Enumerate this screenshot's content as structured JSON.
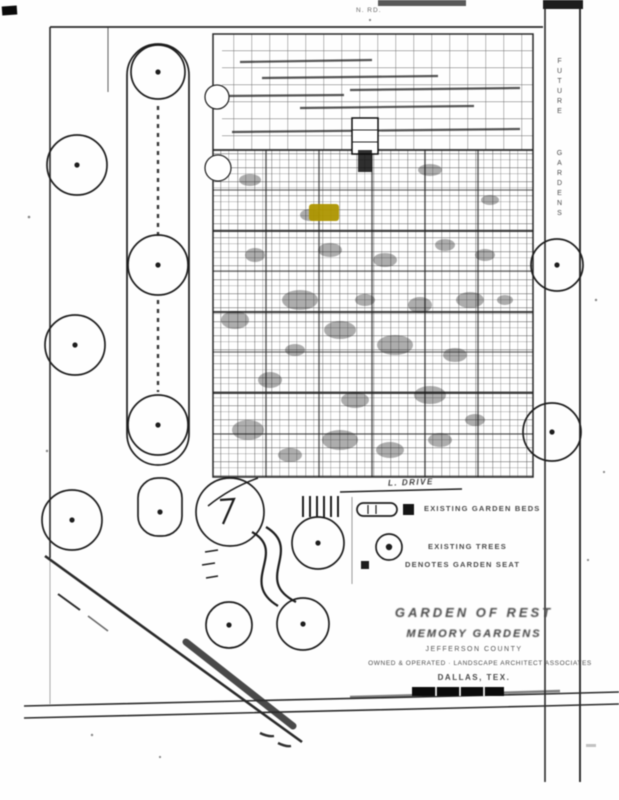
{
  "page": {
    "kind": "scanned plat map",
    "paper_color": "#fefefe",
    "ink_color": "#3a3a3a",
    "highlight_color": "#ab9303"
  },
  "map": {
    "top_road_label": "N. RD.",
    "drive_label": "L. DRIVE",
    "right_road_label_upper": "FUTURE",
    "right_road_label_lower": "GARDENS"
  },
  "legend": {
    "items": [
      {
        "symbol": "garden-bed-oval-and-square",
        "label": "EXISTING GARDEN BEDS"
      },
      {
        "symbol": "tree-circle",
        "label": "EXISTING TREES"
      },
      {
        "symbol": "marker-square",
        "label": "DENOTES GARDEN SEAT"
      }
    ]
  },
  "title_block": {
    "line1": "GARDEN OF REST",
    "line2": "MEMORY GARDENS",
    "line3": "JEFFERSON COUNTY",
    "line4": "OWNED & OPERATED · LANDSCAPE ARCHITECT ASSOCIATES",
    "line5": "DALLAS, TEX."
  }
}
